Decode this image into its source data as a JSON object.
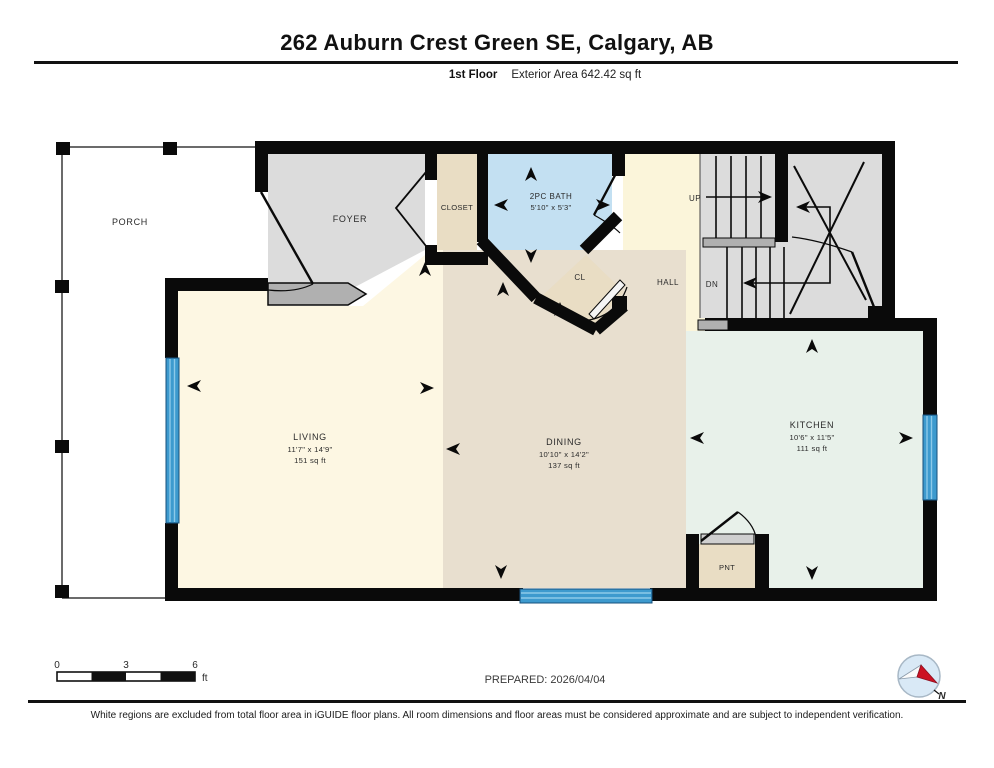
{
  "header": {
    "title": "262 Auburn Crest Green SE, Calgary, AB",
    "floor_label": "1st Floor",
    "area_label": "Exterior Area 642.42 sq ft"
  },
  "rooms": {
    "porch": {
      "label": "PORCH"
    },
    "foyer": {
      "label": "FOYER"
    },
    "closet": {
      "label": "CLOSET"
    },
    "bath": {
      "label": "2PC BATH",
      "dims": "5'10\" x 5'3\""
    },
    "cl": {
      "label": "CL"
    },
    "hall": {
      "label": "HALL"
    },
    "up": {
      "label": "UP"
    },
    "dn": {
      "label": "DN"
    },
    "living": {
      "label": "LIVING",
      "dims": "11'7\" x 14'9\"",
      "area": "151 sq ft"
    },
    "dining": {
      "label": "DINING",
      "dims": "10'10\" x 14'2\"",
      "area": "137 sq ft"
    },
    "kitchen": {
      "label": "KITCHEN",
      "dims": "10'6\" x 11'5\"",
      "area": "111 sq ft"
    },
    "pantry": {
      "label": "PNT"
    }
  },
  "footer": {
    "scale": {
      "t0": "0",
      "t3": "3",
      "t6": "6",
      "unit": "ft"
    },
    "prepared": "PREPARED: 2026/04/04",
    "compass_n": "N",
    "disclaimer": "White regions are excluded from total floor area in iGUIDE floor plans. All room dimensions and floor areas must be considered approximate and are subject to independent verification."
  },
  "colors": {
    "wall": "#0a0a0a",
    "foyer_gray": "#dcdcdc",
    "step_gray": "#b0b0b0",
    "closet_tan": "#e9ddc4",
    "bath_blue": "#c3e0f2",
    "hall_yellow": "#fbf5da",
    "living_cream": "#fdf7e3",
    "dining_beige": "#e8dfcf",
    "kitchen_mint": "#e8f1ea",
    "window_blue": "#3d9ace"
  }
}
